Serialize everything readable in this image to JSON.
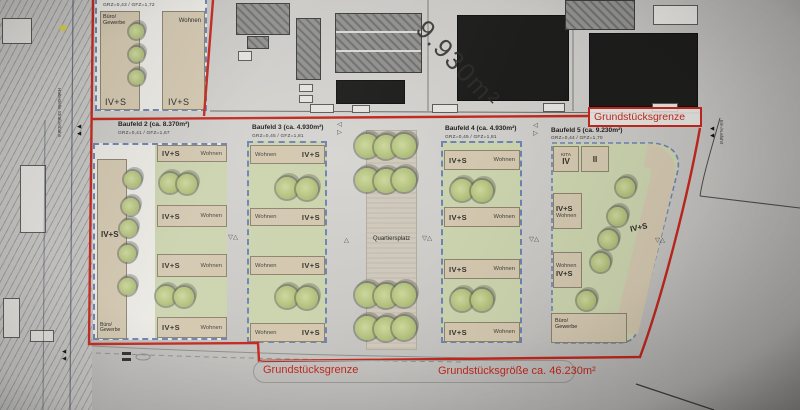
{
  "colors": {
    "boundary_red": "#c3271d",
    "parcel_dashed_blue": "#6d83b2",
    "building_tan": "#d3c7af",
    "lawn_green": "#cbd3ae",
    "tree_green": "#b3c27e",
    "existing_building_gray": "#8f8f8d",
    "existing_building_black": "#1d1d1c",
    "paper_gray": "#c9c8c5",
    "highlight_yellow": "#d8d23a"
  },
  "boundary": {
    "top_label": "Grundstücksgrenze",
    "bottom_label": "Grundstücksgrenze",
    "site_area": "Grundstücksgröße ca. 46.230m²",
    "north_parcel_area": "9.930m²"
  },
  "streets": {
    "tram_stop": "Haltestelle Straßenbahn",
    "entrance": "Ein-/Ausfahrt"
  },
  "plaza": {
    "label": "Quartiersplatz"
  },
  "baufeld1": {
    "grz": "GRZ=0,43 / GFZ=1,72",
    "top_left": "Büro/ Gewerbe",
    "top_right": "Wohnen",
    "bottom_left": "IV+S",
    "bottom_right": "IV+S"
  },
  "baufeld2": {
    "title": "Baufeld 2 (ca. 8.370m²)",
    "grz": "GRZ=0,41 / GFZ=1,67",
    "tower_label": "IV+S",
    "corner_label": "Büro/ Gewerbe",
    "rows": [
      {
        "left": "IV+S",
        "right": "Wohnen"
      },
      {
        "left": "IV+S",
        "right": "Wohnen"
      },
      {
        "left": "IV+S",
        "right": "Wohnen"
      },
      {
        "left": "IV+S",
        "right": "Wohnen"
      }
    ]
  },
  "baufeld3": {
    "title": "Baufeld 3 (ca. 4.930m²)",
    "grz": "GRZ=0,45 / GFZ=1,81",
    "rows": [
      {
        "left": "Wohnen",
        "right": "IV+S"
      },
      {
        "left": "Wohnen",
        "right": "IV+S"
      },
      {
        "left": "Wohnen",
        "right": "IV+S"
      },
      {
        "left": "Wohnen",
        "right": "IV+S"
      }
    ]
  },
  "baufeld4": {
    "title": "Baufeld 4 (ca. 4.930m²)",
    "grz": "GRZ=0,45 / GFZ=1,81",
    "rows": [
      {
        "left": "IV+S",
        "right": "Wohnen"
      },
      {
        "left": "IV+S",
        "right": "Wohnen"
      },
      {
        "left": "IV+S",
        "right": "Wohnen"
      },
      {
        "left": "IV+S",
        "right": "Wohnen"
      }
    ]
  },
  "baufeld5": {
    "title": "Baufeld 5 (ca. 9.230m²)",
    "grz": "GRZ=0,44 / GFZ=1,70",
    "kita_label": "KITA",
    "kita_floors": "IV",
    "building2_floors": "II",
    "block_a_top": "IV+S",
    "block_a_bottom": "Wohnen",
    "block_b_top": "Wohnen",
    "block_b_bottom": "IV+S",
    "edge_label": "IV+S",
    "corner_label": "Büro/ Gewerbe"
  },
  "markers": {
    "survey_pair": "▽△",
    "triangle_up": "△",
    "triangle_left": "◁",
    "triangle_right": "▷",
    "arrow": "◀"
  }
}
